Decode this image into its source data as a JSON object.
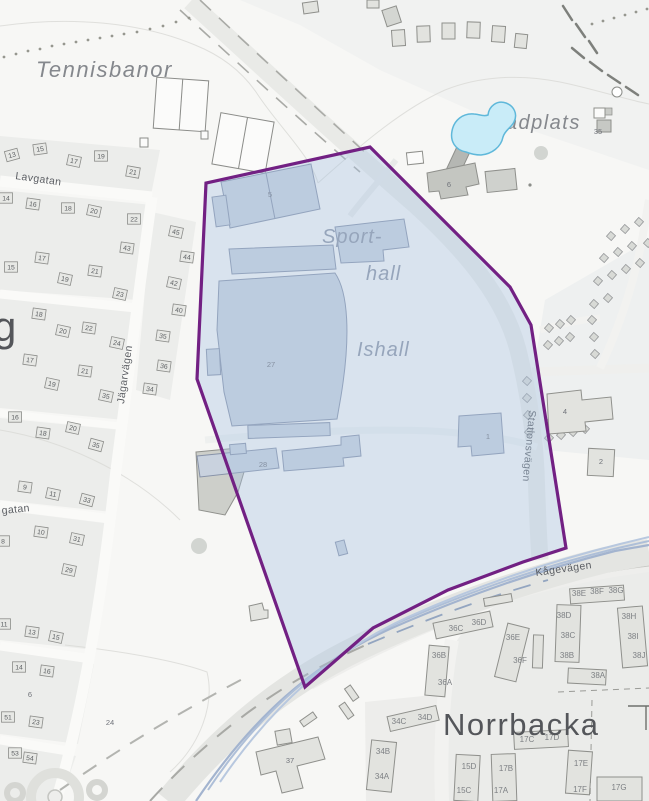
{
  "labels": {
    "tennisbanor": "Tennisbanor",
    "badplats": "Badplats",
    "sport_line1": "Sport-",
    "sport_line2": "hall",
    "ishall": "Ishall",
    "norrbacka": "Norrbacka",
    "district_partial": "g"
  },
  "streets": {
    "lavgatan": "Lavgatan",
    "jagarvagen": "Jägarvägen",
    "stationsvagen": "Stationsvägen",
    "kagevagen": "Kågevägen",
    "gatan_partial": "gatan"
  },
  "numbers": {
    "houses": [
      {
        "n": "13",
        "x": 12,
        "y": 155,
        "r": -15
      },
      {
        "n": "15",
        "x": 40,
        "y": 149,
        "r": -8
      },
      {
        "n": "17",
        "x": 74,
        "y": 161,
        "r": 12
      },
      {
        "n": "19",
        "x": 101,
        "y": 156,
        "r": 0
      },
      {
        "n": "21",
        "x": 133,
        "y": 172,
        "r": 10
      },
      {
        "n": "14",
        "x": 6,
        "y": 198,
        "r": 0
      },
      {
        "n": "16",
        "x": 33,
        "y": 204,
        "r": 8
      },
      {
        "n": "18",
        "x": 68,
        "y": 208,
        "r": 0
      },
      {
        "n": "20",
        "x": 94,
        "y": 211,
        "r": 12
      },
      {
        "n": "22",
        "x": 134,
        "y": 219,
        "r": 0
      },
      {
        "n": "43",
        "x": 127,
        "y": 248,
        "r": 8
      },
      {
        "n": "17",
        "x": 42,
        "y": 258,
        "r": 8
      },
      {
        "n": "15",
        "x": 11,
        "y": 267,
        "r": 0
      },
      {
        "n": "21",
        "x": 95,
        "y": 271,
        "r": 8
      },
      {
        "n": "19",
        "x": 65,
        "y": 279,
        "r": 12
      },
      {
        "n": "23",
        "x": 120,
        "y": 294,
        "r": 12
      },
      {
        "n": "45",
        "x": 176,
        "y": 232,
        "r": 12
      },
      {
        "n": "44",
        "x": 187,
        "y": 257,
        "r": 8
      },
      {
        "n": "42",
        "x": 174,
        "y": 283,
        "r": 12
      },
      {
        "n": "40",
        "x": 179,
        "y": 310,
        "r": 8
      },
      {
        "n": "18",
        "x": 39,
        "y": 314,
        "r": 8
      },
      {
        "n": "20",
        "x": 63,
        "y": 331,
        "r": 12
      },
      {
        "n": "22",
        "x": 89,
        "y": 328,
        "r": 8
      },
      {
        "n": "24",
        "x": 117,
        "y": 343,
        "r": 12
      },
      {
        "n": "35",
        "x": 163,
        "y": 336,
        "r": 8
      },
      {
        "n": "36",
        "x": 164,
        "y": 366,
        "r": 8
      },
      {
        "n": "34",
        "x": 150,
        "y": 389,
        "r": 8
      },
      {
        "n": "17",
        "x": 30,
        "y": 360,
        "r": 8
      },
      {
        "n": "21",
        "x": 85,
        "y": 371,
        "r": 8
      },
      {
        "n": "19",
        "x": 52,
        "y": 384,
        "r": 12
      },
      {
        "n": "35",
        "x": 106,
        "y": 396,
        "r": 12
      },
      {
        "n": "16",
        "x": 15,
        "y": 417,
        "r": 0
      },
      {
        "n": "18",
        "x": 43,
        "y": 433,
        "r": 8
      },
      {
        "n": "20",
        "x": 73,
        "y": 428,
        "r": 12
      },
      {
        "n": "35",
        "x": 96,
        "y": 445,
        "r": 15
      },
      {
        "n": "9",
        "x": 25,
        "y": 487,
        "r": 8
      },
      {
        "n": "11",
        "x": 53,
        "y": 494,
        "r": 12
      },
      {
        "n": "33",
        "x": 87,
        "y": 500,
        "r": 15
      },
      {
        "n": "10",
        "x": 41,
        "y": 532,
        "r": 8
      },
      {
        "n": "8",
        "x": 3,
        "y": 541,
        "r": 0
      },
      {
        "n": "31",
        "x": 77,
        "y": 539,
        "r": 12
      },
      {
        "n": "29",
        "x": 69,
        "y": 570,
        "r": 12
      },
      {
        "n": "11",
        "x": 4,
        "y": 624,
        "r": 0
      },
      {
        "n": "13",
        "x": 32,
        "y": 632,
        "r": 8
      },
      {
        "n": "15",
        "x": 56,
        "y": 637,
        "r": 12
      },
      {
        "n": "14",
        "x": 19,
        "y": 667,
        "r": 0
      },
      {
        "n": "16",
        "x": 47,
        "y": 671,
        "r": 8
      },
      {
        "n": "51",
        "x": 8,
        "y": 717,
        "r": 0
      },
      {
        "n": "23",
        "x": 36,
        "y": 722,
        "r": 8
      },
      {
        "n": "53",
        "x": 15,
        "y": 753,
        "r": 0
      },
      {
        "n": "54",
        "x": 30,
        "y": 758,
        "r": 8
      }
    ],
    "plain": [
      {
        "n": "5",
        "x": 270,
        "y": 197
      },
      {
        "n": "27",
        "x": 271,
        "y": 367
      },
      {
        "n": "28",
        "x": 263,
        "y": 467
      },
      {
        "n": "1",
        "x": 488,
        "y": 439
      },
      {
        "n": "4",
        "x": 565,
        "y": 414
      },
      {
        "n": "2",
        "x": 601,
        "y": 464
      },
      {
        "n": "6",
        "x": 449,
        "y": 187
      },
      {
        "n": "6",
        "x": 30,
        "y": 697
      },
      {
        "n": "24",
        "x": 110,
        "y": 725
      },
      {
        "n": "37",
        "x": 290,
        "y": 763
      },
      {
        "n": "35",
        "x": 598,
        "y": 134
      }
    ],
    "units": [
      {
        "n": "36C",
        "x": 456,
        "y": 631
      },
      {
        "n": "36D",
        "x": 479,
        "y": 625
      },
      {
        "n": "36E",
        "x": 513,
        "y": 640
      },
      {
        "n": "36F",
        "x": 520,
        "y": 663
      },
      {
        "n": "36B",
        "x": 439,
        "y": 658
      },
      {
        "n": "36A",
        "x": 445,
        "y": 685
      },
      {
        "n": "38E",
        "x": 579,
        "y": 596
      },
      {
        "n": "38F",
        "x": 597,
        "y": 594
      },
      {
        "n": "38G",
        "x": 616,
        "y": 593
      },
      {
        "n": "38D",
        "x": 564,
        "y": 618
      },
      {
        "n": "38C",
        "x": 568,
        "y": 638
      },
      {
        "n": "38B",
        "x": 567,
        "y": 658
      },
      {
        "n": "38H",
        "x": 629,
        "y": 619
      },
      {
        "n": "38I",
        "x": 633,
        "y": 639
      },
      {
        "n": "38J",
        "x": 639,
        "y": 658
      },
      {
        "n": "38A",
        "x": 598,
        "y": 678
      },
      {
        "n": "34C",
        "x": 399,
        "y": 724
      },
      {
        "n": "34D",
        "x": 425,
        "y": 720
      },
      {
        "n": "34B",
        "x": 383,
        "y": 754
      },
      {
        "n": "34A",
        "x": 382,
        "y": 779
      },
      {
        "n": "17C",
        "x": 527,
        "y": 742
      },
      {
        "n": "17D",
        "x": 552,
        "y": 740
      },
      {
        "n": "15D",
        "x": 469,
        "y": 769
      },
      {
        "n": "17B",
        "x": 506,
        "y": 771
      },
      {
        "n": "17E",
        "x": 581,
        "y": 766
      },
      {
        "n": "15C",
        "x": 464,
        "y": 793
      },
      {
        "n": "17A",
        "x": 501,
        "y": 793
      },
      {
        "n": "17F",
        "x": 580,
        "y": 792
      },
      {
        "n": "17G",
        "x": 619,
        "y": 790
      }
    ]
  },
  "colors": {
    "plan_boundary": "#722083",
    "plan_fill": "#a9c3e1",
    "water_fill": "#c9ecf8",
    "water_stroke": "#5fb8da"
  }
}
